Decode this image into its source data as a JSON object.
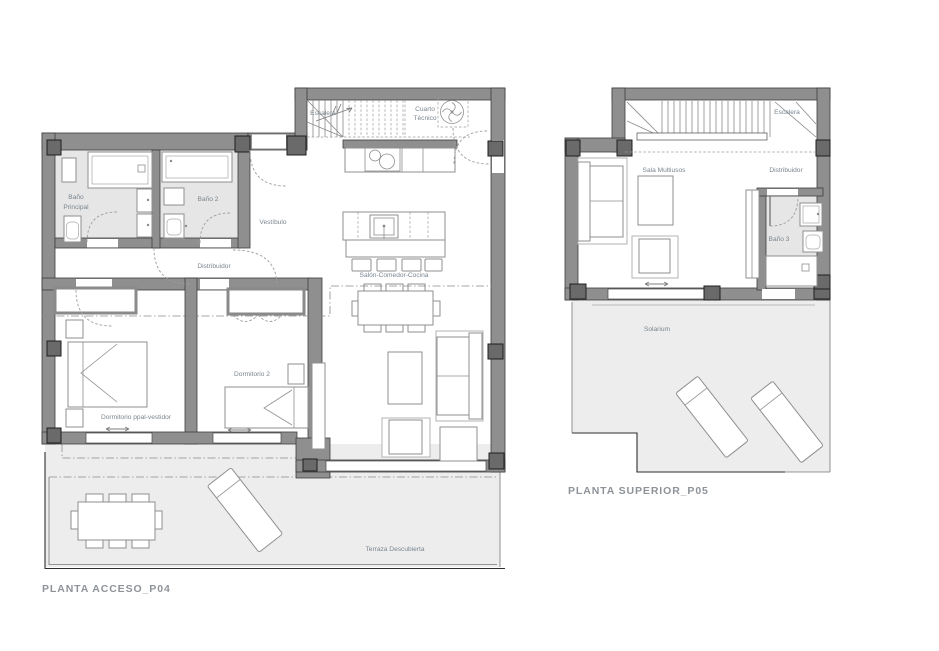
{
  "colors": {
    "wall_fill": "#8f8f8f",
    "wall_outline": "#3e3e3e",
    "pillar_fill": "#6a6a6a",
    "bathroom_floor": "#e6e6e6",
    "terrace_floor": "#ededed",
    "furniture_stroke": "#8f8f8f",
    "label_text": "#79858f",
    "title_text": "#8d9399"
  },
  "plans": {
    "access": {
      "title": "PLANTA ACCESO_P04",
      "rooms": {
        "bano_principal_l1": "Baño",
        "bano_principal_l2": "Principal",
        "bano2": "Baño 2",
        "vestibulo": "Vestíbulo",
        "distribuidor": "Distribuidor",
        "escalera": "Escalera",
        "cuarto_tecnico_l1": "Cuarto",
        "cuarto_tecnico_l2": "Técnico",
        "salon_comedor_cocina": "Salón-Comedor-Cocina",
        "dormitorio_ppal": "Dormitorio ppal-vestidor",
        "dormitorio_2": "Dormitorio 2",
        "terraza": "Terraza Descubierta"
      }
    },
    "superior": {
      "title": "PLANTA SUPERIOR_P05",
      "rooms": {
        "escalera": "Escalera",
        "sala_multiusos": "Sala Multiusos",
        "distribuidor": "Distribuidor",
        "bano3": "Baño 3",
        "solarium": "Solarium"
      }
    }
  }
}
